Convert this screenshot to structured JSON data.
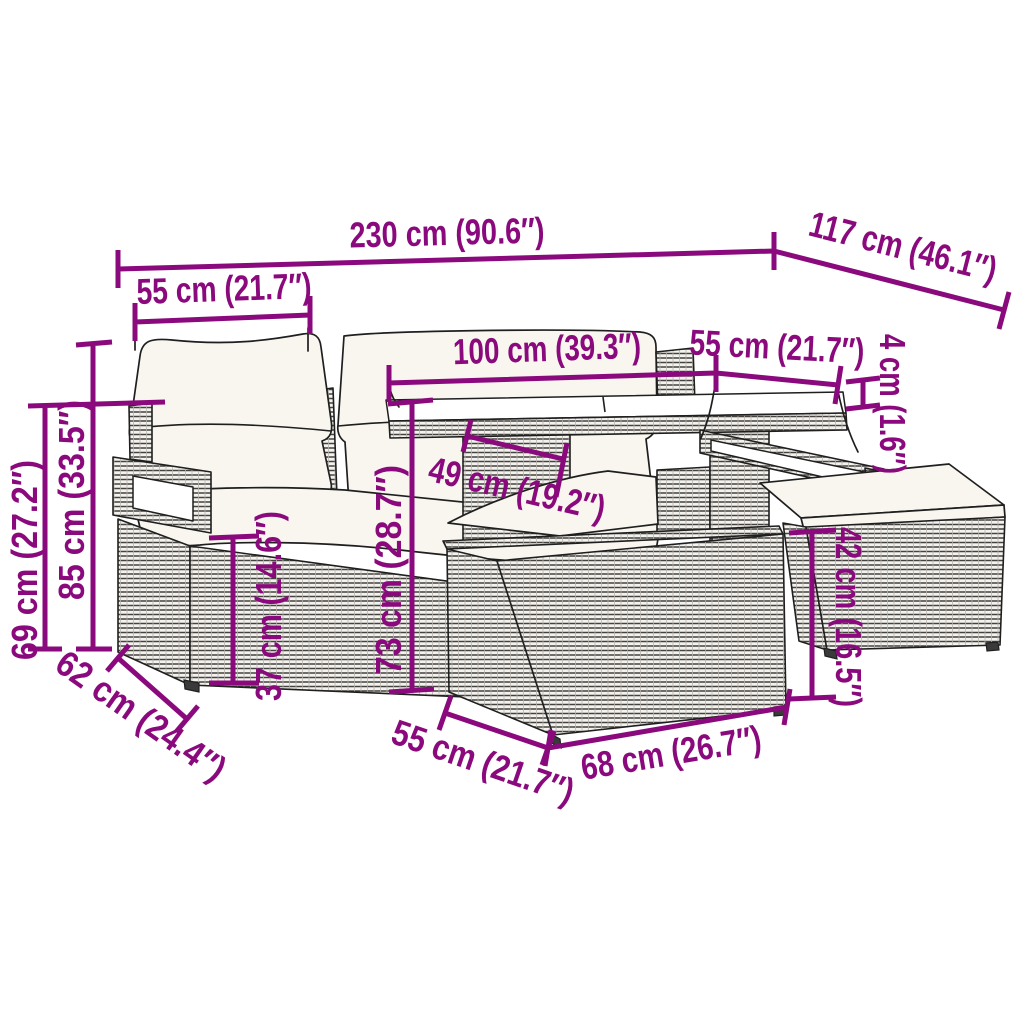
{
  "diagram": {
    "subject": "Poly rattan garden lounge set with glass-top table — product dimension diagram",
    "background": "#ffffff",
    "accent_color": "#8a0a7d",
    "line_color": "#1f1f1f",
    "cushion_color": "#f8f6ef",
    "annotations": {
      "total_width": {
        "label": "230 cm (90.6″)",
        "cm": 230,
        "inches": 90.6
      },
      "total_depth": {
        "label": "117 cm (46.1″)",
        "cm": 117,
        "inches": 46.1
      },
      "left_seat_width": {
        "label": "55 cm (21.7″)",
        "cm": 55,
        "inches": 21.7
      },
      "table_width": {
        "label": "100 cm (39.3″)",
        "cm": 100,
        "inches": 39.3
      },
      "rear_seat_width": {
        "label": "55 cm (21.7″)",
        "cm": 55,
        "inches": 21.7
      },
      "tabletop_thickness": {
        "label": "4 cm (1.6″)",
        "cm": 4,
        "inches": 1.6
      },
      "armrest_height": {
        "label": "69 cm (27.2″)",
        "cm": 69,
        "inches": 27.2
      },
      "backrest_height": {
        "label": "85 cm (33.5″)",
        "cm": 85,
        "inches": 33.5
      },
      "seat_height": {
        "label": "37 cm (14.6″)",
        "cm": 37,
        "inches": 14.6
      },
      "table_height": {
        "label": "73 cm (28.7″)",
        "cm": 73,
        "inches": 28.7
      },
      "table_clearance": {
        "label": "49 cm (19.2″)",
        "cm": 49,
        "inches": 19.2
      },
      "stool_height": {
        "label": "42 cm (16.5″)",
        "cm": 42,
        "inches": 16.5
      },
      "sofa_depth": {
        "label": "62 cm (24.4″)",
        "cm": 62,
        "inches": 24.4
      },
      "stool_depth": {
        "label": "55 cm (21.7″)",
        "cm": 55,
        "inches": 21.7
      },
      "stool_width": {
        "label": "68 cm (26.7″)",
        "cm": 68,
        "inches": 26.7
      }
    }
  }
}
